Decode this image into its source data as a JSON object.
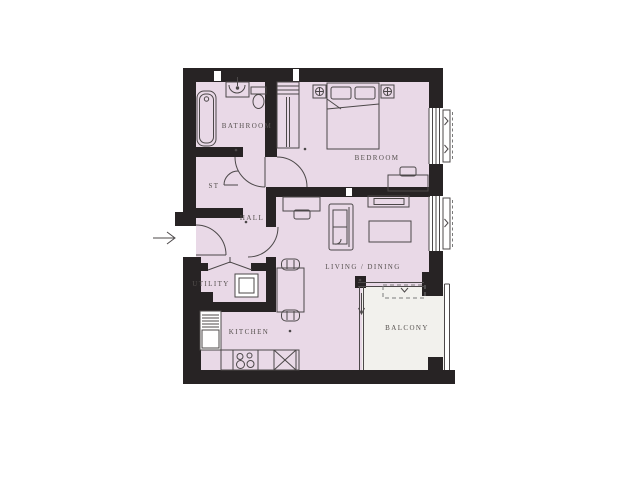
{
  "page": {
    "type": "architectural-floor-plan",
    "background": "#ffffff"
  },
  "rooms": [
    {
      "id": "bathroom",
      "label": "BATHROOM"
    },
    {
      "id": "st",
      "label": "ST"
    },
    {
      "id": "hall",
      "label": "HALL"
    },
    {
      "id": "bedroom",
      "label": "BEDROOM"
    },
    {
      "id": "utility",
      "label": "UTILITY"
    },
    {
      "id": "living_dining",
      "label": "LIVING / DINING"
    },
    {
      "id": "kitchen",
      "label": "KITCHEN"
    },
    {
      "id": "balcony",
      "label": "BALCONY"
    }
  ],
  "entry": {
    "arrow_symbol": "→"
  },
  "colors": {
    "wall": "#272324",
    "floor": "#e9d9e7",
    "balcony_floor": "#f2f1ed",
    "furniture_line": "#4c4849",
    "text": "#55504e",
    "dashed_line": "#7a7a7a"
  },
  "fixtures": [
    "bathtub",
    "washbasin",
    "toilet",
    "wardrobe",
    "double-bed",
    "bedside-table",
    "desk",
    "chair",
    "sofa",
    "tv-unit",
    "coffee-table",
    "dining-table",
    "washing-machine",
    "fridge-freezer",
    "hob",
    "kitchen-sink",
    "window",
    "bifold-door",
    "sliding-balcony-door"
  ]
}
